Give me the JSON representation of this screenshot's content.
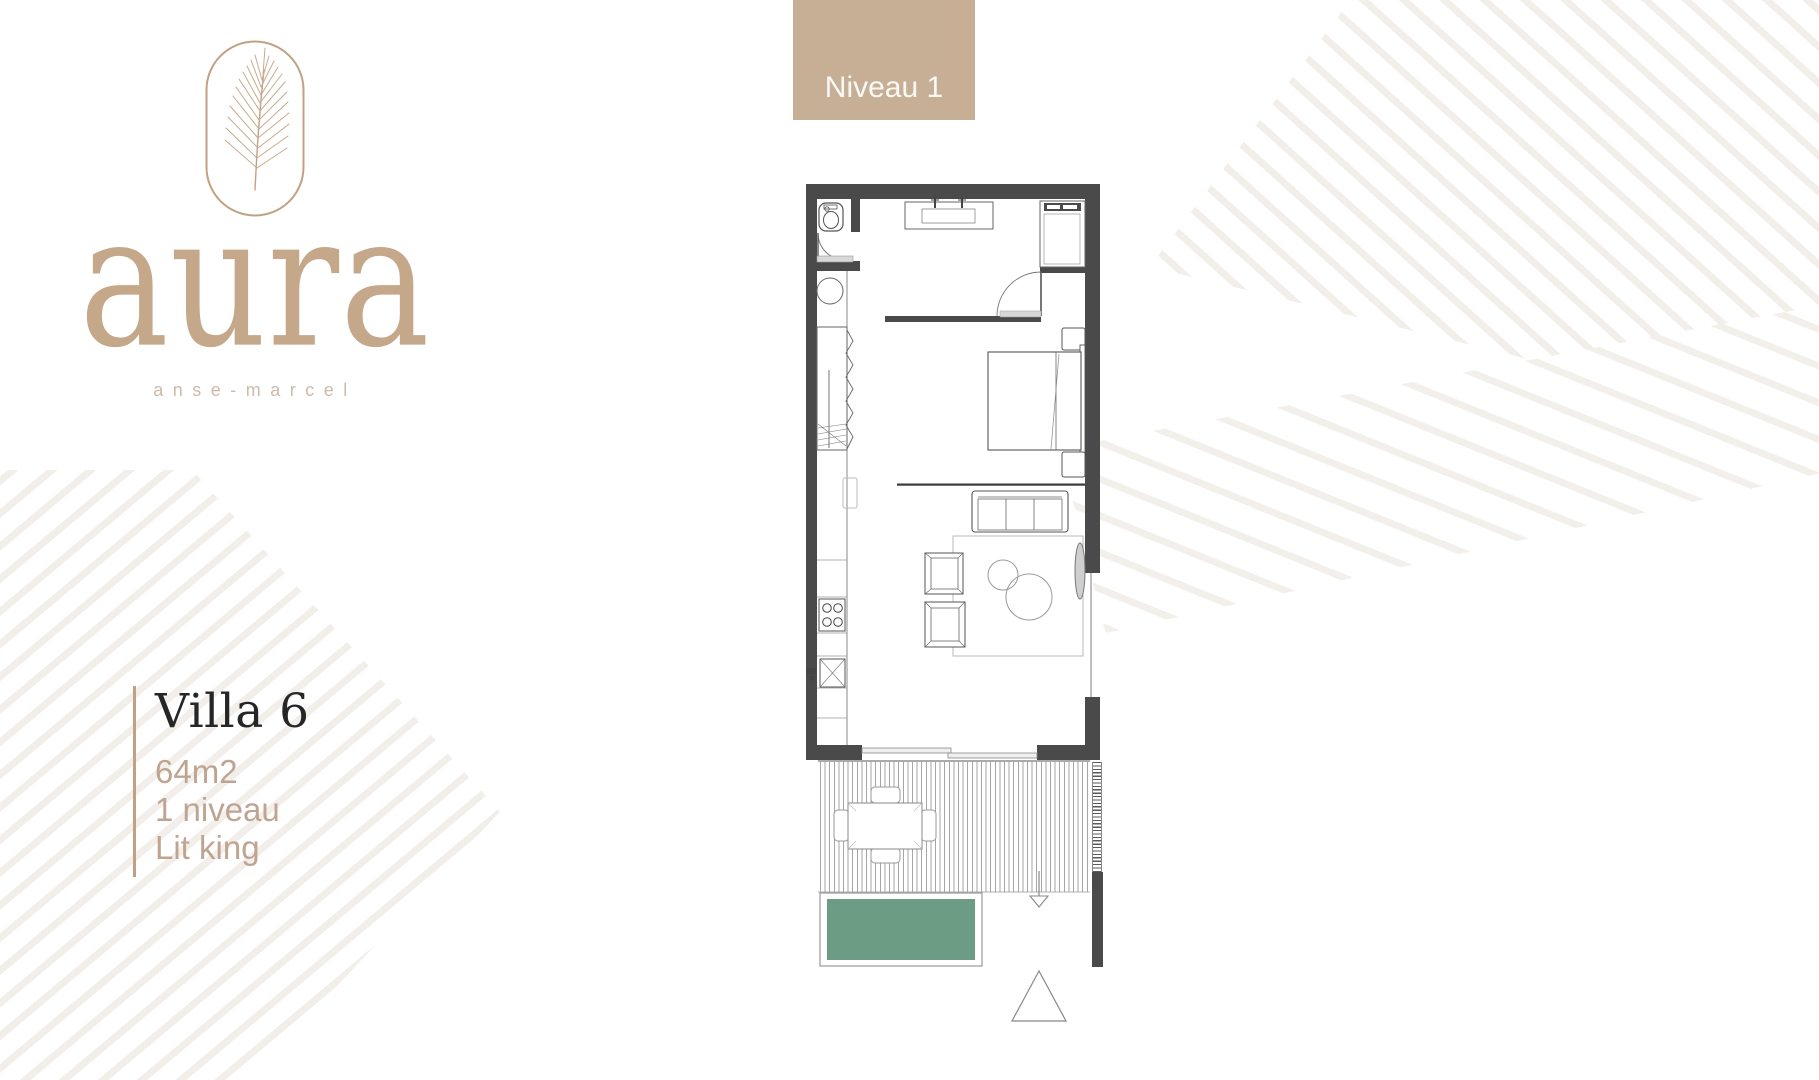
{
  "brand": {
    "name": "aura",
    "subtitle": "anse-marcel",
    "accent_color": "#c2a183",
    "logo_icon": "palm-leaf-icon"
  },
  "level_tab": {
    "label": "Niveau 1",
    "bg_color": "#c7af95",
    "text_color": "#fbf9f5"
  },
  "villa": {
    "title": "Villa 6",
    "details": [
      "64m2",
      "1 niveau",
      "Lit king"
    ],
    "text_color": "#bfa492"
  },
  "floor_plan": {
    "wall_color": "#4a4a4a",
    "pool_color": "#6d9c85",
    "features": [
      "toilet",
      "washbasin-vanity",
      "shower",
      "wardrobe",
      "washing-machine",
      "kitchen-counter",
      "cooktop",
      "sink",
      "king-bed",
      "nightstands",
      "sofa",
      "armchairs",
      "coffee-tables",
      "rug",
      "sliding-glass-door",
      "terrace-deck",
      "outdoor-dining-set",
      "pool",
      "entrance-arrow",
      "north-triangle"
    ]
  },
  "watermark": {
    "motif": "palm-frond"
  }
}
